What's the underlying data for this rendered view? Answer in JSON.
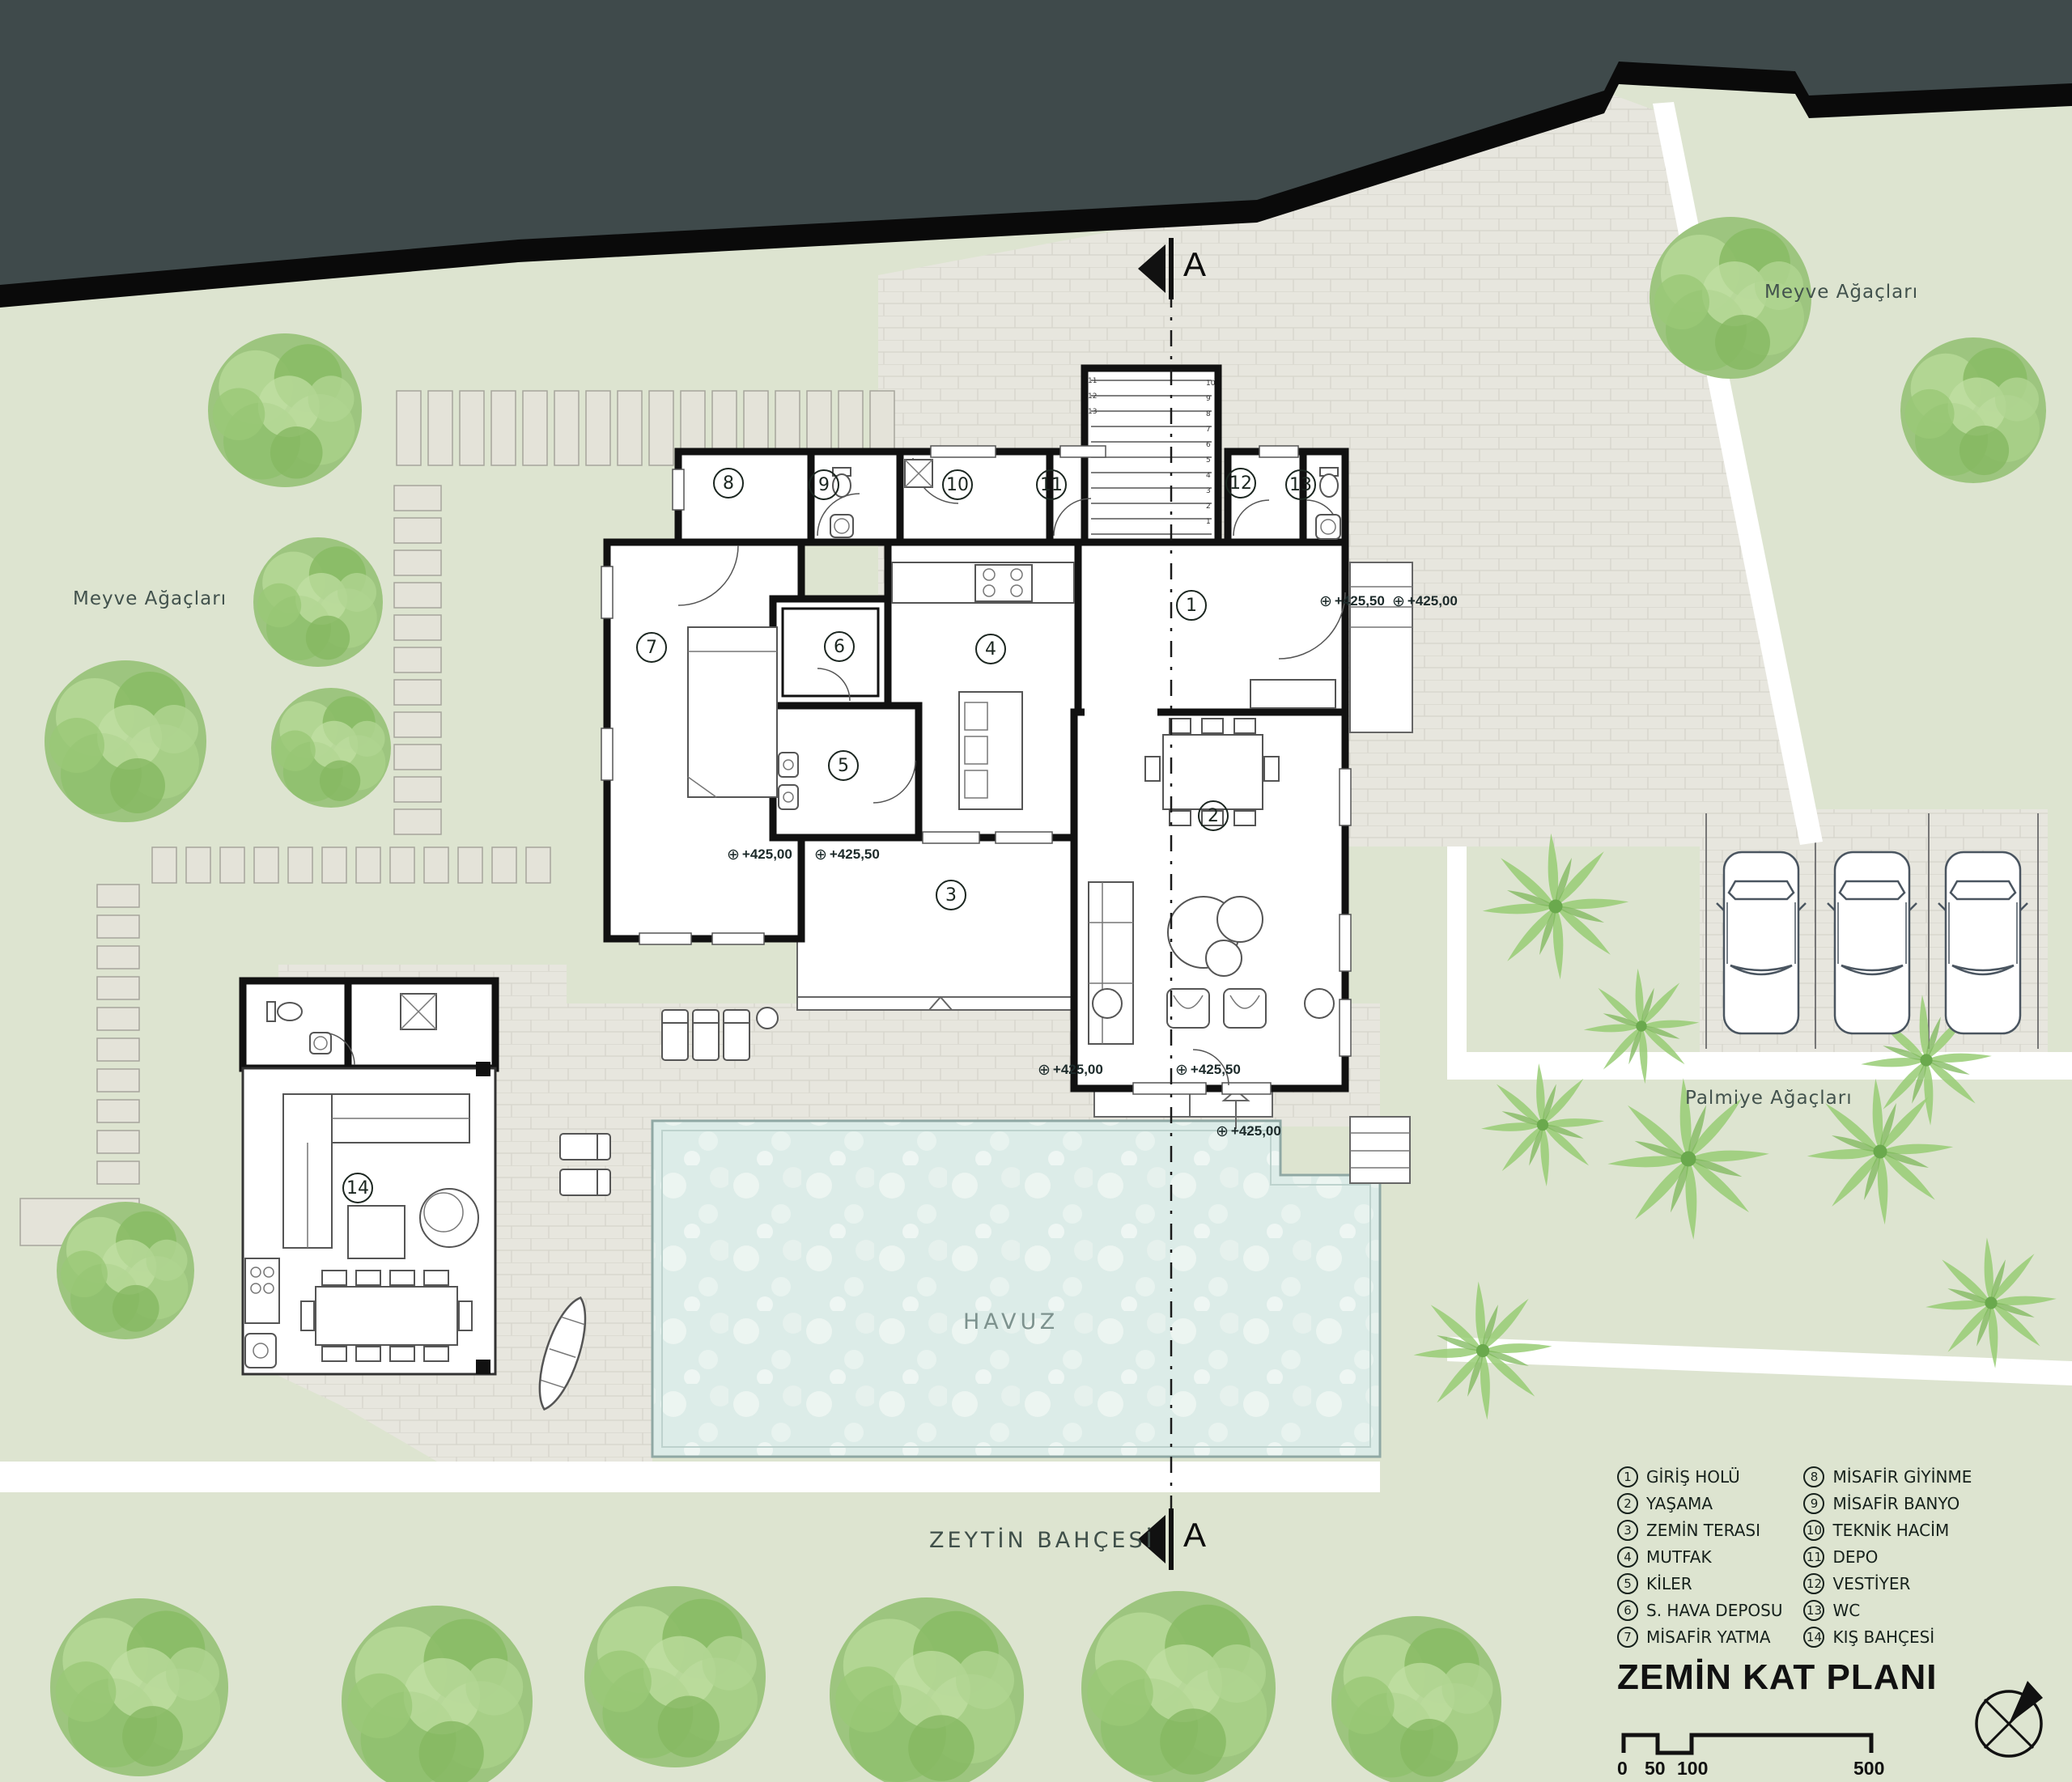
{
  "title": "ZEMİN KAT PLANI",
  "labels": {
    "fruit_left": "Meyve Ağaçları",
    "fruit_right": "Meyve Ağaçları",
    "palms": "Palmiye Ağaçları",
    "olive": "ZEYTİN BAHÇESİ",
    "pool": "HAVUZ"
  },
  "section_letter": "A",
  "rooms": [
    {
      "num": "1",
      "label": "GİRİŞ HOLÜ"
    },
    {
      "num": "2",
      "label": "YAŞAMA"
    },
    {
      "num": "3",
      "label": "ZEMİN TERASI"
    },
    {
      "num": "4",
      "label": "MUTFAK"
    },
    {
      "num": "5",
      "label": "KİLER"
    },
    {
      "num": "6",
      "label": "S. HAVA DEPOSU"
    },
    {
      "num": "7",
      "label": "MİSAFİR YATMA"
    },
    {
      "num": "8",
      "label": "MİSAFİR GİYİNME"
    },
    {
      "num": "9",
      "label": "MİSAFİR BANYO"
    },
    {
      "num": "10",
      "label": "TEKNİK HACİM"
    },
    {
      "num": "11",
      "label": "DEPO"
    },
    {
      "num": "12",
      "label": "VESTİYER"
    },
    {
      "num": "13",
      "label": "WC"
    },
    {
      "num": "14",
      "label": "KIŞ BAHÇESİ"
    }
  ],
  "elevations": {
    "entry_a": "+425,50",
    "entry_b": "+425,00",
    "terrace_a": "+425,00",
    "terrace_b": "+425,50",
    "porch_a": "+425,00",
    "porch_b": "+425,50",
    "porch_c": "+425,00"
  },
  "scalebar": {
    "zero": "0",
    "fifty": "50",
    "hundred": "100",
    "fivehundred": "500"
  },
  "stairs": {
    "treads": [
      "1",
      "2",
      "3",
      "4",
      "5",
      "6",
      "7",
      "8",
      "9",
      "10",
      "11",
      "12",
      "13"
    ]
  },
  "colors": {
    "road": "#3f4a4b",
    "grass": "#dde4d0",
    "paver": "#e7e6de",
    "water": "#dcece8",
    "tree": "#9dc57f",
    "wall": "#111111"
  }
}
